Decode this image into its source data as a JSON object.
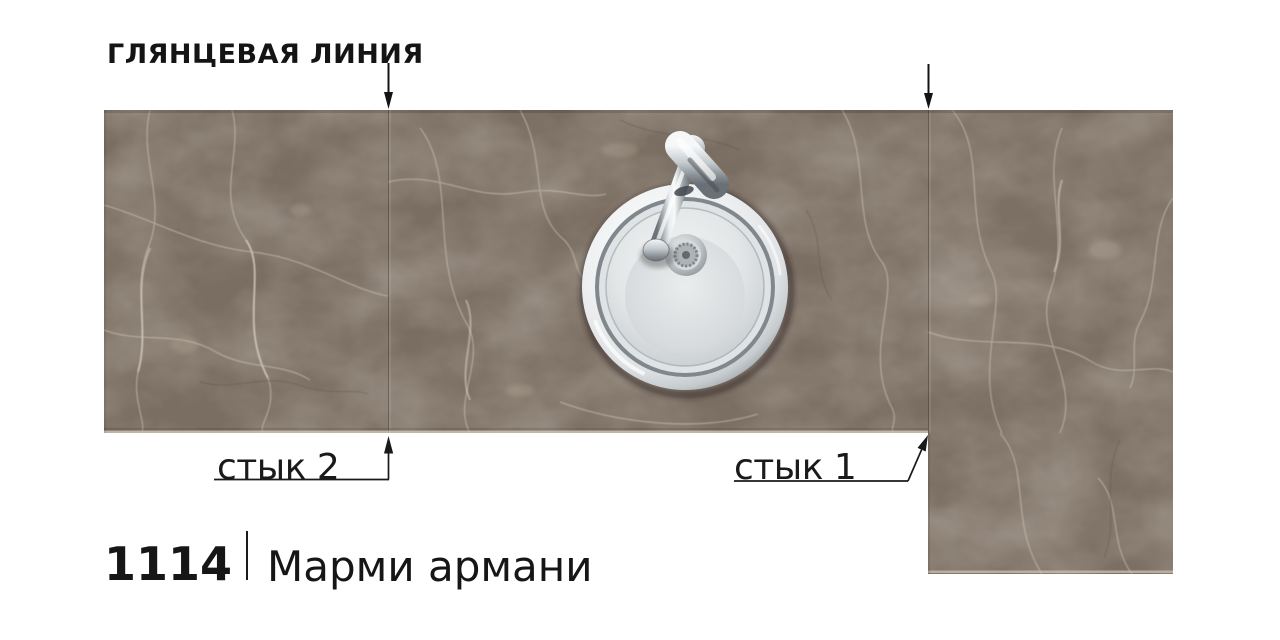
{
  "header": {
    "glossy_line_label": "ГЛЯНЦЕВАЯ ЛИНИЯ"
  },
  "seams": {
    "seam1_label": "стык 1",
    "seam2_label": "стык 2"
  },
  "footer": {
    "decor_code": "1114",
    "decor_name": "Марми армани"
  },
  "colors": {
    "background": "#ffffff",
    "annotation": "#161616",
    "marble_base": "#7a6d62",
    "marble_dark": "#60564c",
    "marble_vein_light": "#d6cdba",
    "marble_crack_dark": "#564a40",
    "steel_light": "#f4f6f7",
    "steel_mid": "#b7bdc1",
    "steel_dark": "#6c7378"
  }
}
